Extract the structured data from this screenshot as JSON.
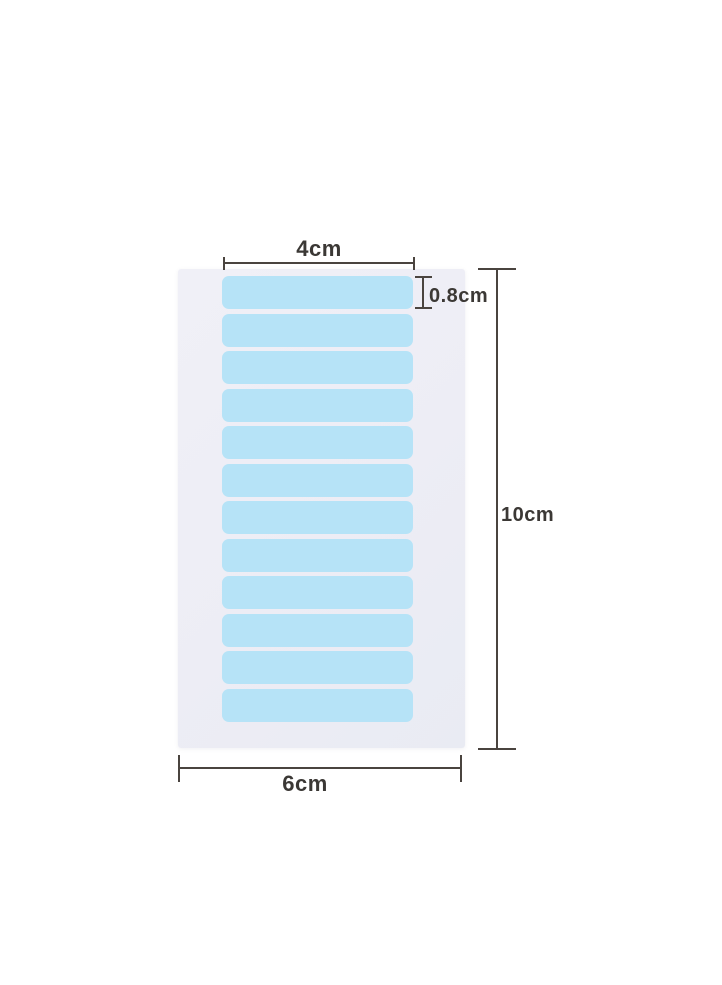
{
  "page": {
    "background_color": "#ffffff"
  },
  "diagram": {
    "description": "Sheet of blue adhesive tape tabs with measurement annotations",
    "sheet": {
      "color": "#ededf5",
      "tab_color": "#b6e3f7",
      "tab_count": 12
    },
    "dimensions": {
      "line_color": "#4a443f",
      "text_color": "#3b3835",
      "tab_width": {
        "label": "4cm"
      },
      "tab_height": {
        "label": "0.8cm"
      },
      "sheet_height": {
        "label": "10cm"
      },
      "sheet_width": {
        "label": "6cm"
      }
    }
  }
}
